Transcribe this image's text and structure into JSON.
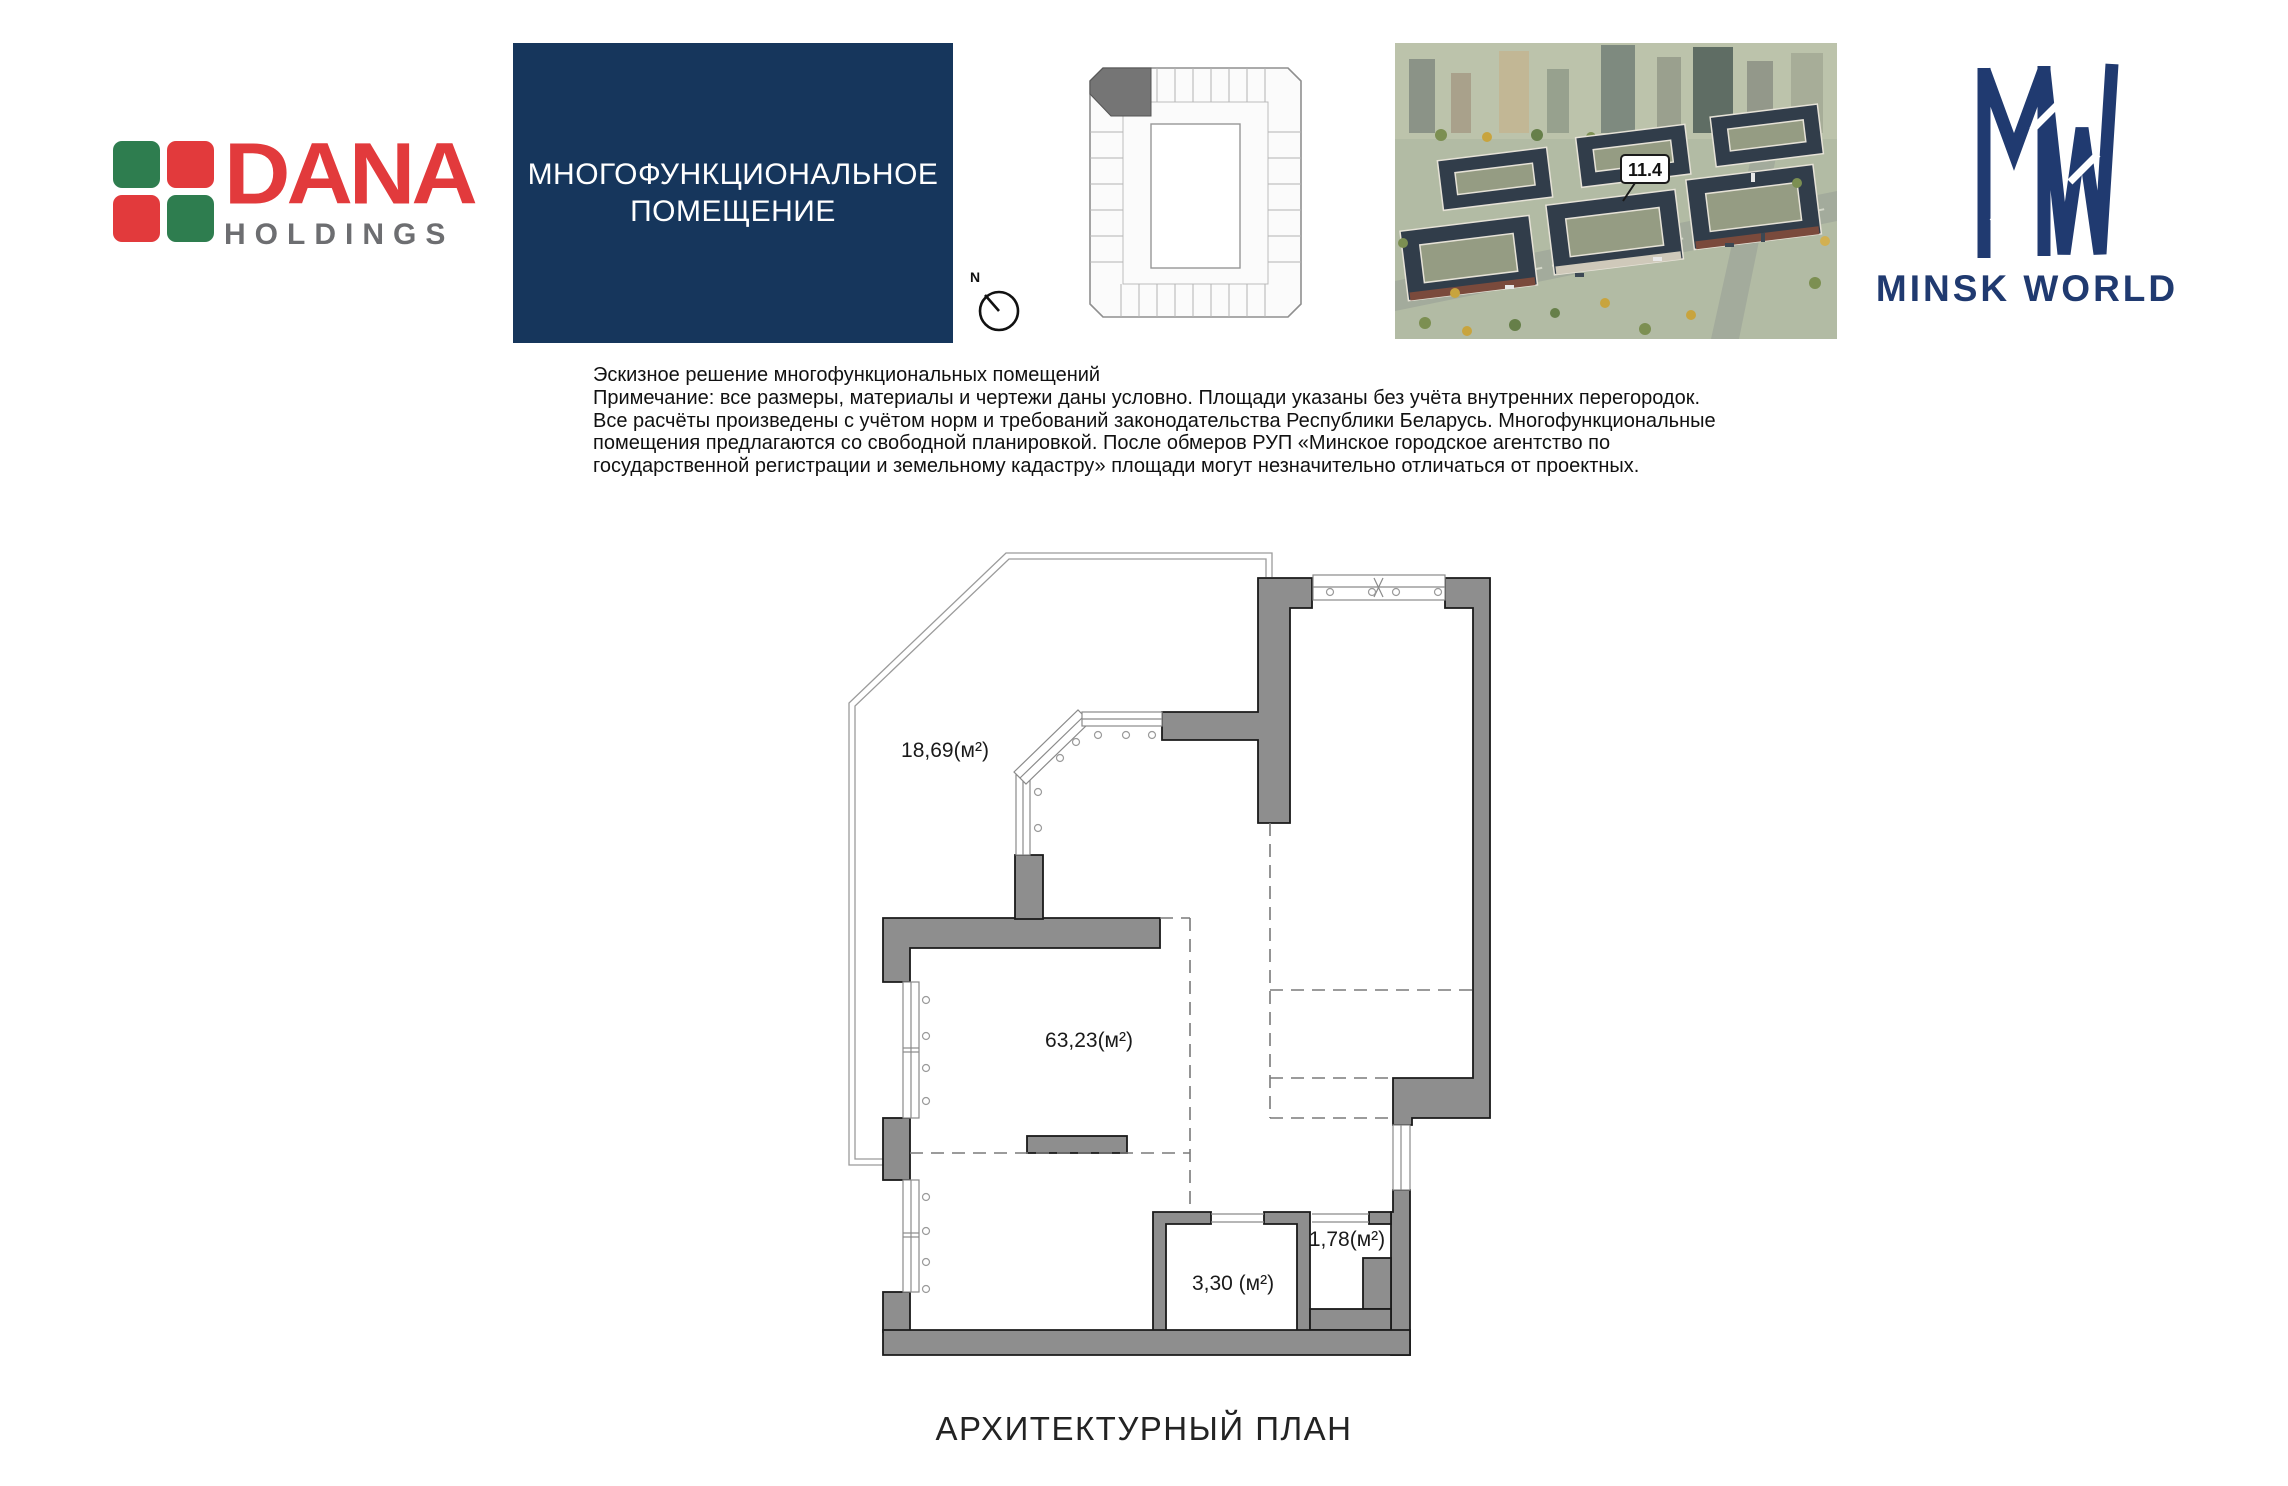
{
  "header": {
    "dana": {
      "name": "DANA",
      "sub": "HOLDINGS",
      "red": "#e23a3c",
      "green": "#2e7d4f",
      "gray": "#6d6e71"
    },
    "title_box": {
      "line1": "МНОГОФУНКЦИОНАЛЬНОЕ",
      "line2": "ПОМЕЩЕНИЕ",
      "bg": "#16365c"
    },
    "keyplan": {
      "compass_label": "N",
      "highlight_color": "#757575"
    },
    "aerial": {
      "building_label": "11.4"
    },
    "minsk_world": {
      "brand": "MINSK WORLD",
      "navy": "#203a70"
    }
  },
  "notes": {
    "lines": [
      "Эскизное решение многофункциональных помещений",
      "Примечание: все размеры, материалы и чертежи даны условно. Площади указаны без учёта внутренних перегородок.",
      "Все расчёты произведены с учётом норм и требований законодательства Республики Беларусь. Многофункциональные",
      "помещения предлагаются со свободной планировкой. После обмеров РУП «Минское городское агентство по",
      "государственной регистрации и земельному кадастру» площади могут незначительно отличаться от проектных."
    ]
  },
  "plan": {
    "wall_color": "#8e8e8e",
    "areas": [
      {
        "room": "terrace",
        "label": "18,69(м²)"
      },
      {
        "room": "main-room",
        "label": "63,23(м²)"
      },
      {
        "room": "bathroom",
        "label": "3,30 (м²)"
      },
      {
        "room": "storage",
        "label": "1,78(м²)"
      }
    ]
  },
  "footer": {
    "title": "АРХИТЕКТУРНЫЙ ПЛАН"
  }
}
